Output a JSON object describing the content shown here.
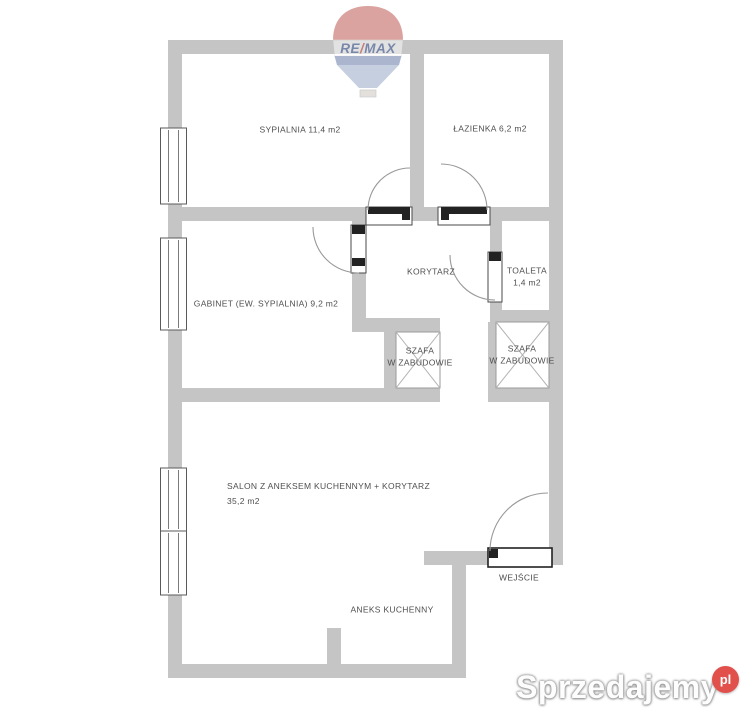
{
  "plan": {
    "rooms": {
      "sypialnia": "SYPIALNIA 11,4 m2",
      "lazienka": "ŁAZIENKA 6,2 m2",
      "korytarz": "KORYTARZ",
      "toaleta_name": "TOALETA",
      "toaleta_area": "1,4 m2",
      "gabinet": "GABINET (EW. SYPIALNIA) 9,2 m2",
      "szafa_line1": "SZAFA",
      "szafa_line2": "W ZABUDOWIE",
      "salon_name": "SALON Z ANEKSEM KUCHENNYM + KORYTARZ",
      "salon_area": "35,2 m2",
      "aneks": "ANEKS KUCHENNY",
      "wejscie": "WEJŚCIE"
    },
    "colors": {
      "wall": "#c5c5c5",
      "label_text": "#4f4f4f",
      "door_dark": "#222222",
      "arc": "#999999",
      "watermark_badge": "#e2504c"
    }
  },
  "branding": {
    "remax": {
      "re": "RE",
      "slash": "/",
      "max": "MAX"
    },
    "watermark": {
      "text": "Sprzedajemy",
      "tld": "pl"
    }
  }
}
